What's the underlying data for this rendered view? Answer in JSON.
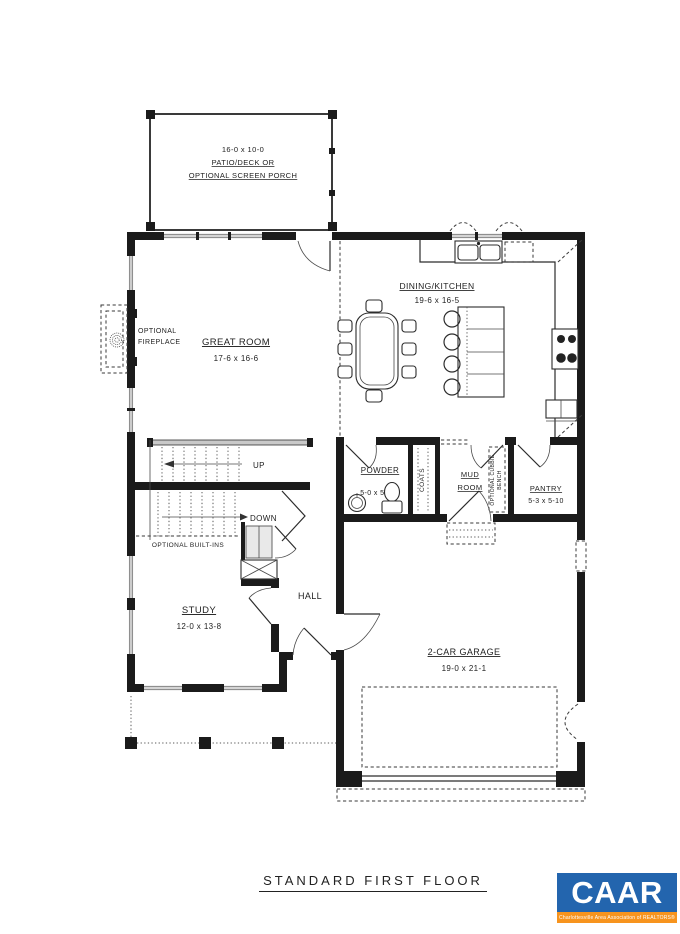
{
  "plan": {
    "patio": {
      "dims": "16-0 x 10-0",
      "line1": "PATIO/DECK OR",
      "line2": "OPTIONAL SCREEN PORCH"
    },
    "great_room": {
      "name": "GREAT ROOM",
      "dims": "17-6 x 16-6"
    },
    "fireplace": {
      "line1": "OPTIONAL",
      "line2": "FIREPLACE"
    },
    "dining_kitchen": {
      "name": "DINING/KITCHEN",
      "dims": "19-6 x 16-5"
    },
    "stairs": {
      "up": "UP",
      "down": "DOWN"
    },
    "powder": {
      "name": "POWDER",
      "dims": "5-0 x 5-10"
    },
    "coats": {
      "name": "COATS"
    },
    "mud_room": {
      "line1": "MUD",
      "line2": "ROOM"
    },
    "cubbies": {
      "line1": "OPTIONAL CUBBIE",
      "line2": "BENCH"
    },
    "pantry": {
      "name": "PANTRY",
      "dims": "5-3 x 5-10"
    },
    "built_ins": {
      "name": "OPTIONAL BUILT-INS"
    },
    "study": {
      "name": "STUDY",
      "dims": "12-0 x 13-8"
    },
    "hall": {
      "name": "HALL"
    },
    "garage": {
      "name": "2-CAR GARAGE",
      "dims": "19-0 x 21-1"
    }
  },
  "footer": {
    "title": "STANDARD FIRST FLOOR"
  },
  "logo": {
    "text": "CAAR",
    "tagline": "Charlottesville Area Association of REALTORS®",
    "blue": "#2365ae",
    "orange": "#f7941e",
    "text_color": "#ffffff"
  }
}
